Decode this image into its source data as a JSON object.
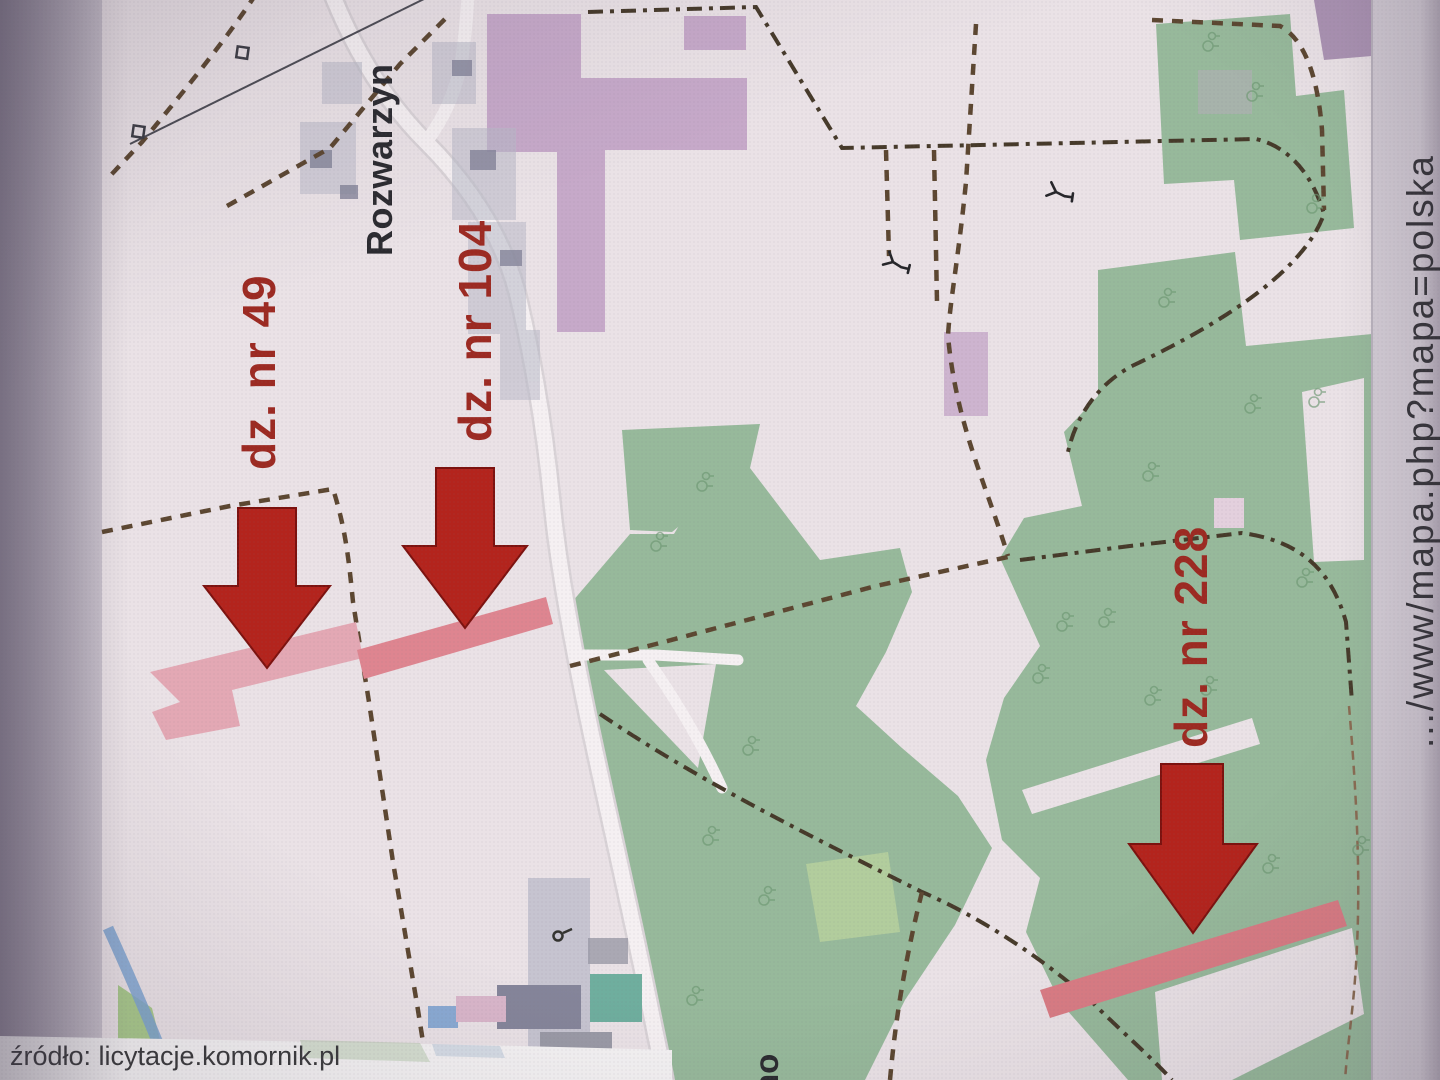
{
  "map_labels": {
    "parcel49": "dz. nr 49",
    "parcel104": "dz. nr 104",
    "parcel228": "dz. nr 228",
    "village": "Rozwarzyn",
    "village_partial": "no"
  },
  "caption": {
    "source": "źródło: licytacje.komornik.pl"
  },
  "margin": {
    "url_fragment": ".../www/mapa.php?mapa=polska"
  },
  "icons": {
    "arrows": "arrow-down-icon",
    "wind_turbine": "wind-turbine-icon",
    "trees": "tree-icon",
    "power_pylon": "pylon-icon"
  },
  "colors": {
    "paper": "#cbc4ce",
    "map_bg": "#eae2e6",
    "forest": "#97b99b",
    "forest_light": "#b2cd9d",
    "built": "#c6a9c9",
    "built_dark": "#ab93b3",
    "built_light": "#e3d0dd",
    "road": "#f5f0f2",
    "road_casing": "#d9d3d7",
    "dash": "#5c4731",
    "boundary": "#463a2a",
    "arrow": "#b3241d",
    "arrow_outline": "#7c120f",
    "parcel49": "#e3a8b4",
    "parcel104": "#de8590",
    "parcel228": "#d97c84",
    "stream": "#7fa4d0",
    "pond": "#6fae9e",
    "grass": "#a9c98c",
    "village_gray": "#b9bac8",
    "building": "#85859a",
    "label_red": "#9c2a22",
    "label_black": "#2b2b30",
    "caption": "#3b3b3d",
    "url_text": "#202024",
    "white_strip": "#f4f2f3"
  }
}
